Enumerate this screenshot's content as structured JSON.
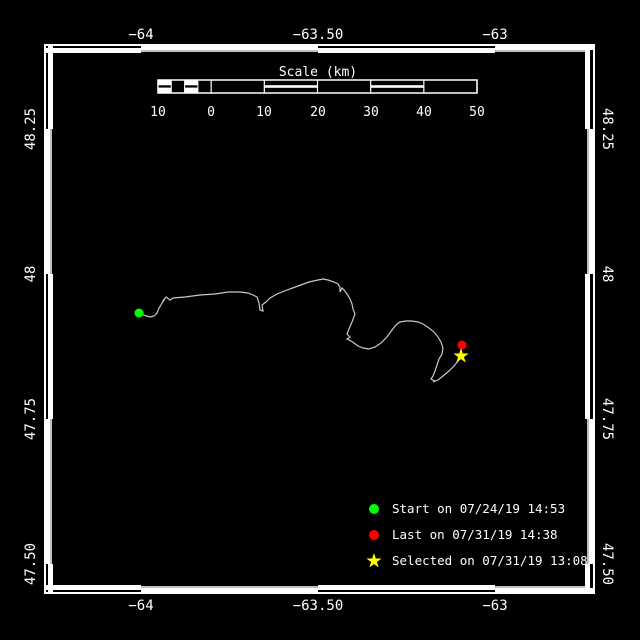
{
  "colors": {
    "background": "#000000",
    "frame": "#ffffff",
    "track": "#c8c8c8",
    "start": "#00ff00",
    "last": "#ff0000",
    "selected": "#ffff00"
  },
  "axes": {
    "lon_labels": [
      "−64",
      "−63.50",
      "−63"
    ],
    "lat_labels": [
      "48.25",
      "48",
      "47.75",
      "47.50"
    ]
  },
  "scalebar": {
    "title": "Scale (km)",
    "tick_labels": [
      "10",
      "0",
      "10",
      "20",
      "30",
      "40",
      "50"
    ]
  },
  "legend": {
    "items": [
      {
        "marker": "circle-icon",
        "color": "#00ff00",
        "label": "Start on 07/24/19 14:53"
      },
      {
        "marker": "circle-icon",
        "color": "#ff0000",
        "label": "Last on 07/31/19 14:38"
      },
      {
        "marker": "star-icon",
        "color": "#ffff00",
        "label": "Selected on 07/31/19 13:08"
      }
    ]
  },
  "chart_data": {
    "type": "line",
    "title": "",
    "xlabel": "Longitude (deg)",
    "ylabel": "Latitude (deg)",
    "x_ticks": [
      -64,
      -63.5,
      -63
    ],
    "y_ticks": [
      48.25,
      48,
      47.75,
      47.5
    ],
    "xlim": [
      -64.27,
      -62.72
    ],
    "ylim": [
      47.44,
      48.39
    ],
    "grid": false,
    "legend_position": "lower-right",
    "track_color": "#c8c8c8",
    "track": [
      [
        -64.0056,
        47.9328
      ],
      [
        -63.9944,
        47.9293
      ],
      [
        -63.9746,
        47.9259
      ],
      [
        -63.9633,
        47.9276
      ],
      [
        -63.9548,
        47.9328
      ],
      [
        -63.9492,
        47.9414
      ],
      [
        -63.9435,
        47.9466
      ],
      [
        -63.935,
        47.9569
      ],
      [
        -63.9407,
        47.95
      ],
      [
        -63.9294,
        47.9603
      ],
      [
        -63.9181,
        47.9552
      ],
      [
        -63.9096,
        47.9586
      ],
      [
        -63.8757,
        47.9603
      ],
      [
        -63.8333,
        47.9638
      ],
      [
        -63.791,
        47.9655
      ],
      [
        -63.7542,
        47.969
      ],
      [
        -63.7203,
        47.969
      ],
      [
        -63.6977,
        47.9672
      ],
      [
        -63.6836,
        47.9638
      ],
      [
        -63.6723,
        47.9603
      ],
      [
        -63.6667,
        47.95
      ],
      [
        -63.6638,
        47.9379
      ],
      [
        -63.6554,
        47.9362
      ],
      [
        -63.6582,
        47.9466
      ],
      [
        -63.6469,
        47.9517
      ],
      [
        -63.6356,
        47.9586
      ],
      [
        -63.6158,
        47.9655
      ],
      [
        -63.5876,
        47.9724
      ],
      [
        -63.5565,
        47.9793
      ],
      [
        -63.5254,
        47.9862
      ],
      [
        -63.5,
        47.9897
      ],
      [
        -63.4859,
        47.9914
      ],
      [
        -63.4718,
        47.9897
      ],
      [
        -63.4548,
        47.9862
      ],
      [
        -63.4435,
        47.9828
      ],
      [
        -63.4379,
        47.9776
      ],
      [
        -63.4379,
        47.969
      ],
      [
        -63.4322,
        47.9759
      ],
      [
        -63.4266,
        47.9724
      ],
      [
        -63.4181,
        47.9655
      ],
      [
        -63.4096,
        47.9569
      ],
      [
        -63.404,
        47.9483
      ],
      [
        -63.4011,
        47.9397
      ],
      [
        -63.3955,
        47.931
      ],
      [
        -63.404,
        47.9172
      ],
      [
        -63.4124,
        47.9052
      ],
      [
        -63.4181,
        47.8966
      ],
      [
        -63.4096,
        47.8914
      ],
      [
        -63.4181,
        47.8879
      ],
      [
        -63.4068,
        47.8845
      ],
      [
        -63.3983,
        47.881
      ],
      [
        -63.387,
        47.8759
      ],
      [
        -63.3729,
        47.8724
      ],
      [
        -63.3559,
        47.8707
      ],
      [
        -63.339,
        47.8741
      ],
      [
        -63.322,
        47.881
      ],
      [
        -63.3051,
        47.8914
      ],
      [
        -63.291,
        47.9034
      ],
      [
        -63.2797,
        47.9121
      ],
      [
        -63.2684,
        47.9172
      ],
      [
        -63.2514,
        47.919
      ],
      [
        -63.2345,
        47.919
      ],
      [
        -63.2175,
        47.9172
      ],
      [
        -63.2034,
        47.9138
      ],
      [
        -63.1864,
        47.9069
      ],
      [
        -63.1723,
        47.9
      ],
      [
        -63.161,
        47.8914
      ],
      [
        -63.1525,
        47.8828
      ],
      [
        -63.1469,
        47.8724
      ],
      [
        -63.1497,
        47.8621
      ],
      [
        -63.1582,
        47.8534
      ],
      [
        -63.1638,
        47.8431
      ],
      [
        -63.1695,
        47.8328
      ],
      [
        -63.1751,
        47.8241
      ],
      [
        -63.1808,
        47.819
      ],
      [
        -63.1695,
        47.8155
      ],
      [
        -63.1751,
        47.8138
      ],
      [
        -63.161,
        47.8172
      ],
      [
        -63.1469,
        47.8241
      ],
      [
        -63.1299,
        47.8328
      ],
      [
        -63.1158,
        47.8414
      ],
      [
        -63.1045,
        47.85
      ],
      [
        -63.096,
        47.8569
      ]
    ],
    "markers": [
      {
        "name": "start",
        "lon": -64.0056,
        "lat": 47.9328,
        "color": "#00ff00",
        "shape": "circle"
      },
      {
        "name": "last",
        "lon": -63.0932,
        "lat": 47.8776,
        "color": "#ff0000",
        "shape": "circle"
      },
      {
        "name": "selected",
        "lon": -63.096,
        "lat": 47.8586,
        "color": "#ffff00",
        "shape": "star"
      }
    ]
  }
}
